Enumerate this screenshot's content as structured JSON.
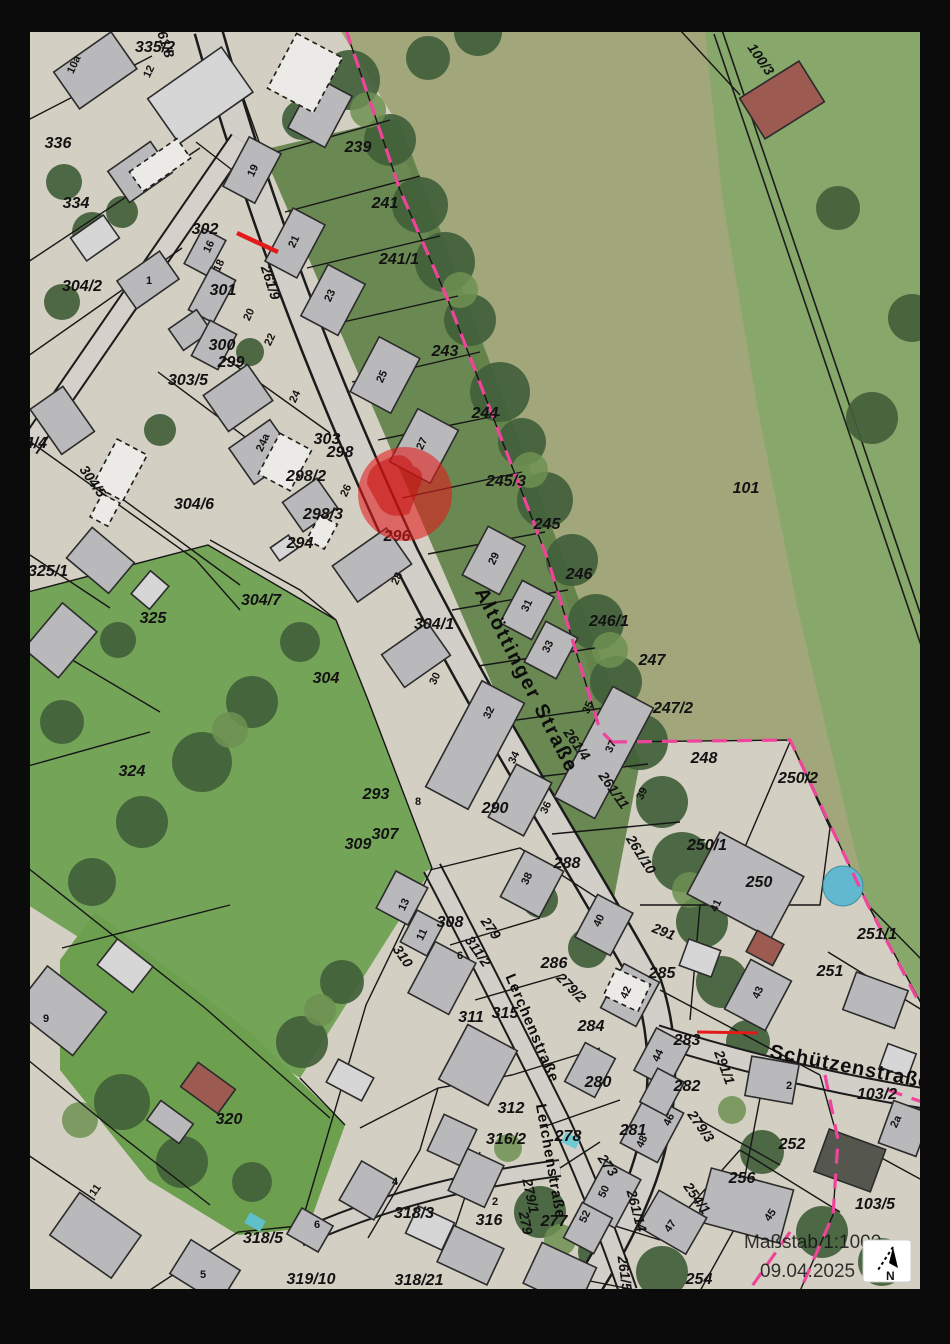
{
  "legend": {
    "scale": "Maßstab 1:1000",
    "date": "09.04.2025",
    "north": "N"
  },
  "colors": {
    "marker_red": "#e31a1a",
    "boundary_magenta": "#f0439b",
    "building_gray": "#b9b9bb",
    "parcel_line": "#161616"
  },
  "map": {
    "street_labels": [
      {
        "t": "Altöttinger Straße",
        "x": 521,
        "y": 683,
        "r": 63,
        "s": 20,
        "ls": 2
      },
      {
        "t": "Lerchenstraße",
        "x": 528,
        "y": 1030,
        "r": 67,
        "s": 15,
        "ls": 1
      },
      {
        "t": "Lerchenstraße",
        "x": 546,
        "y": 1162,
        "r": 80,
        "s": 15,
        "ls": 1
      },
      {
        "t": "Schützenstraße",
        "x": 849,
        "y": 1073,
        "r": 11,
        "s": 20,
        "ls": 1
      }
    ],
    "road_parcel_labels": [
      {
        "t": "261/8",
        "x": 160,
        "y": 42,
        "r": 72
      },
      {
        "t": "261/9",
        "x": 266,
        "y": 284,
        "r": 72
      },
      {
        "t": "261/4",
        "x": 573,
        "y": 747,
        "r": 55
      },
      {
        "t": "261/11",
        "x": 610,
        "y": 793,
        "r": 55
      },
      {
        "t": "261/10",
        "x": 637,
        "y": 857,
        "r": 58
      },
      {
        "t": "261/14",
        "x": 632,
        "y": 1212,
        "r": 75
      },
      {
        "t": "261/5",
        "x": 620,
        "y": 1274,
        "r": 82
      },
      {
        "t": "279/3",
        "x": 697,
        "y": 1129,
        "r": 55
      },
      {
        "t": "291/1",
        "x": 720,
        "y": 1069,
        "r": 70
      },
      {
        "t": "279/1",
        "x": 526,
        "y": 1197,
        "r": 78
      },
      {
        "t": "279",
        "x": 521,
        "y": 1224,
        "r": 78
      },
      {
        "t": "254/1",
        "x": 693,
        "y": 1201,
        "r": 55
      },
      {
        "t": "279",
        "x": 487,
        "y": 931,
        "r": 55
      },
      {
        "t": "311/2",
        "x": 474,
        "y": 954,
        "r": 55
      },
      {
        "t": "310",
        "x": 399,
        "y": 959,
        "r": 55
      },
      {
        "t": "291",
        "x": 662,
        "y": 936,
        "r": 22
      },
      {
        "t": "100/3",
        "x": 757,
        "y": 62,
        "r": 55
      },
      {
        "t": "304/5",
        "x": 89,
        "y": 484,
        "r": 55
      },
      {
        "t": "273",
        "x": 604,
        "y": 1168,
        "r": 55
      },
      {
        "t": "279/2",
        "x": 568,
        "y": 991,
        "r": 45
      }
    ],
    "parcel_labels": [
      {
        "t": "335/2",
        "x": 155,
        "y": 52
      },
      {
        "t": "336",
        "x": 58,
        "y": 148
      },
      {
        "t": "334",
        "x": 76,
        "y": 208
      },
      {
        "t": "302",
        "x": 205,
        "y": 234
      },
      {
        "t": "301",
        "x": 223,
        "y": 295
      },
      {
        "t": "300",
        "x": 222,
        "y": 350
      },
      {
        "t": "299",
        "x": 231,
        "y": 367
      },
      {
        "t": "303/5",
        "x": 188,
        "y": 385
      },
      {
        "t": "304/2",
        "x": 82,
        "y": 291
      },
      {
        "t": "4/4",
        "x": 36,
        "y": 448
      },
      {
        "t": "304/6",
        "x": 194,
        "y": 509
      },
      {
        "t": "325/1",
        "x": 48,
        "y": 576
      },
      {
        "t": "325",
        "x": 153,
        "y": 623
      },
      {
        "t": "304/7",
        "x": 261,
        "y": 605
      },
      {
        "t": "303",
        "x": 327,
        "y": 444
      },
      {
        "t": "298",
        "x": 340,
        "y": 457
      },
      {
        "t": "298/2",
        "x": 306,
        "y": 481
      },
      {
        "t": "298/3",
        "x": 323,
        "y": 519
      },
      {
        "t": "294",
        "x": 300,
        "y": 548
      },
      {
        "t": "296",
        "x": 397,
        "y": 541
      },
      {
        "t": "304/1",
        "x": 434,
        "y": 629
      },
      {
        "t": "304",
        "x": 326,
        "y": 683
      },
      {
        "t": "324",
        "x": 132,
        "y": 776
      },
      {
        "t": "293",
        "x": 376,
        "y": 799
      },
      {
        "t": "307",
        "x": 385,
        "y": 839
      },
      {
        "t": "309",
        "x": 358,
        "y": 849
      },
      {
        "t": "290",
        "x": 495,
        "y": 813
      },
      {
        "t": "288",
        "x": 567,
        "y": 868
      },
      {
        "t": "239",
        "x": 358,
        "y": 152
      },
      {
        "t": "241",
        "x": 385,
        "y": 208
      },
      {
        "t": "241/1",
        "x": 399,
        "y": 264
      },
      {
        "t": "243",
        "x": 445,
        "y": 356
      },
      {
        "t": "244",
        "x": 485,
        "y": 418
      },
      {
        "t": "245/3",
        "x": 506,
        "y": 486
      },
      {
        "t": "245",
        "x": 547,
        "y": 529
      },
      {
        "t": "246",
        "x": 579,
        "y": 579
      },
      {
        "t": "246/1",
        "x": 609,
        "y": 626
      },
      {
        "t": "247",
        "x": 652,
        "y": 665
      },
      {
        "t": "247/2",
        "x": 673,
        "y": 713
      },
      {
        "t": "248",
        "x": 704,
        "y": 763
      },
      {
        "t": "250/2",
        "x": 798,
        "y": 783
      },
      {
        "t": "250/1",
        "x": 707,
        "y": 850
      },
      {
        "t": "250",
        "x": 759,
        "y": 887
      },
      {
        "t": "251/1",
        "x": 877,
        "y": 939
      },
      {
        "t": "251",
        "x": 830,
        "y": 976
      },
      {
        "t": "101",
        "x": 746,
        "y": 493
      },
      {
        "t": "285",
        "x": 662,
        "y": 978
      },
      {
        "t": "283",
        "x": 687,
        "y": 1045
      },
      {
        "t": "282",
        "x": 687,
        "y": 1091
      },
      {
        "t": "284",
        "x": 591,
        "y": 1031
      },
      {
        "t": "286",
        "x": 554,
        "y": 968
      },
      {
        "t": "280",
        "x": 598,
        "y": 1087
      },
      {
        "t": "281",
        "x": 633,
        "y": 1135
      },
      {
        "t": "278",
        "x": 568,
        "y": 1141
      },
      {
        "t": "277",
        "x": 554,
        "y": 1226
      },
      {
        "t": "308",
        "x": 450,
        "y": 927
      },
      {
        "t": "311",
        "x": 471,
        "y": 1022
      },
      {
        "t": "315",
        "x": 505,
        "y": 1018
      },
      {
        "t": "312",
        "x": 511,
        "y": 1113
      },
      {
        "t": "316/2",
        "x": 506,
        "y": 1144
      },
      {
        "t": "316",
        "x": 489,
        "y": 1225
      },
      {
        "t": "318/3",
        "x": 414,
        "y": 1218
      },
      {
        "t": "318/5",
        "x": 263,
        "y": 1243
      },
      {
        "t": "318/21",
        "x": 419,
        "y": 1285
      },
      {
        "t": "319/10",
        "x": 311,
        "y": 1284
      },
      {
        "t": "320",
        "x": 229,
        "y": 1124
      },
      {
        "t": "103/2",
        "x": 877,
        "y": 1099
      },
      {
        "t": "252",
        "x": 792,
        "y": 1149
      },
      {
        "t": "256",
        "x": 742,
        "y": 1183
      },
      {
        "t": "103/5",
        "x": 875,
        "y": 1209
      },
      {
        "t": "254",
        "x": 699,
        "y": 1284
      }
    ],
    "house_numbers": [
      {
        "t": "10a",
        "x": 77,
        "y": 66,
        "r": -65
      },
      {
        "t": "12",
        "x": 152,
        "y": 73,
        "r": -65
      },
      {
        "t": "1",
        "x": 149,
        "y": 284,
        "r": 0
      },
      {
        "t": "16",
        "x": 212,
        "y": 248,
        "r": -65
      },
      {
        "t": "18",
        "x": 222,
        "y": 267,
        "r": -65
      },
      {
        "t": "20",
        "x": 252,
        "y": 316,
        "r": -65
      },
      {
        "t": "22",
        "x": 273,
        "y": 341,
        "r": -65
      },
      {
        "t": "24",
        "x": 298,
        "y": 398,
        "r": -65
      },
      {
        "t": "24a",
        "x": 266,
        "y": 444,
        "r": -65
      },
      {
        "t": "26",
        "x": 349,
        "y": 492,
        "r": -65
      },
      {
        "t": "28",
        "x": 400,
        "y": 580,
        "r": -65
      },
      {
        "t": "30",
        "x": 438,
        "y": 680,
        "r": -65
      },
      {
        "t": "32",
        "x": 492,
        "y": 714,
        "r": -65
      },
      {
        "t": "34",
        "x": 517,
        "y": 759,
        "r": -65
      },
      {
        "t": "36",
        "x": 549,
        "y": 809,
        "r": -65
      },
      {
        "t": "38",
        "x": 530,
        "y": 880,
        "r": -65
      },
      {
        "t": "40",
        "x": 602,
        "y": 922,
        "r": -65
      },
      {
        "t": "42",
        "x": 629,
        "y": 994,
        "r": -65
      },
      {
        "t": "44",
        "x": 661,
        "y": 1057,
        "r": -65
      },
      {
        "t": "46",
        "x": 672,
        "y": 1121,
        "r": -65
      },
      {
        "t": "48",
        "x": 645,
        "y": 1143,
        "r": -65
      },
      {
        "t": "50",
        "x": 607,
        "y": 1193,
        "r": -65
      },
      {
        "t": "52",
        "x": 588,
        "y": 1218,
        "r": -65
      },
      {
        "t": "19",
        "x": 256,
        "y": 172,
        "r": -65
      },
      {
        "t": "21",
        "x": 297,
        "y": 243,
        "r": -65
      },
      {
        "t": "23",
        "x": 333,
        "y": 297,
        "r": -65
      },
      {
        "t": "25",
        "x": 385,
        "y": 378,
        "r": -65
      },
      {
        "t": "27",
        "x": 425,
        "y": 445,
        "r": -65
      },
      {
        "t": "29",
        "x": 497,
        "y": 560,
        "r": -65
      },
      {
        "t": "31",
        "x": 530,
        "y": 607,
        "r": -65
      },
      {
        "t": "33",
        "x": 551,
        "y": 648,
        "r": -65
      },
      {
        "t": "35",
        "x": 591,
        "y": 709,
        "r": -65
      },
      {
        "t": "37",
        "x": 614,
        "y": 748,
        "r": -65
      },
      {
        "t": "39",
        "x": 645,
        "y": 795,
        "r": -65
      },
      {
        "t": "41",
        "x": 719,
        "y": 907,
        "r": -65
      },
      {
        "t": "43",
        "x": 761,
        "y": 994,
        "r": -65
      },
      {
        "t": "45",
        "x": 773,
        "y": 1217,
        "r": -55
      },
      {
        "t": "47",
        "x": 673,
        "y": 1228,
        "r": -55
      },
      {
        "t": "2a",
        "x": 899,
        "y": 1123,
        "r": -65
      },
      {
        "t": "2",
        "x": 789,
        "y": 1089,
        "r": 0
      },
      {
        "t": "2",
        "x": 495,
        "y": 1205,
        "r": 0
      },
      {
        "t": "4",
        "x": 395,
        "y": 1185,
        "r": 0
      },
      {
        "t": "6",
        "x": 317,
        "y": 1228,
        "r": 0
      },
      {
        "t": "5",
        "x": 203,
        "y": 1278,
        "r": 0
      },
      {
        "t": "8",
        "x": 418,
        "y": 805,
        "r": 0
      },
      {
        "t": "6",
        "x": 460,
        "y": 959,
        "r": 0
      },
      {
        "t": "13",
        "x": 407,
        "y": 906,
        "r": -65
      },
      {
        "t": "11",
        "x": 425,
        "y": 936,
        "r": -65
      },
      {
        "t": "9",
        "x": 46,
        "y": 1022,
        "r": 0
      },
      {
        "t": "11",
        "x": 98,
        "y": 1192,
        "r": -55
      }
    ]
  }
}
